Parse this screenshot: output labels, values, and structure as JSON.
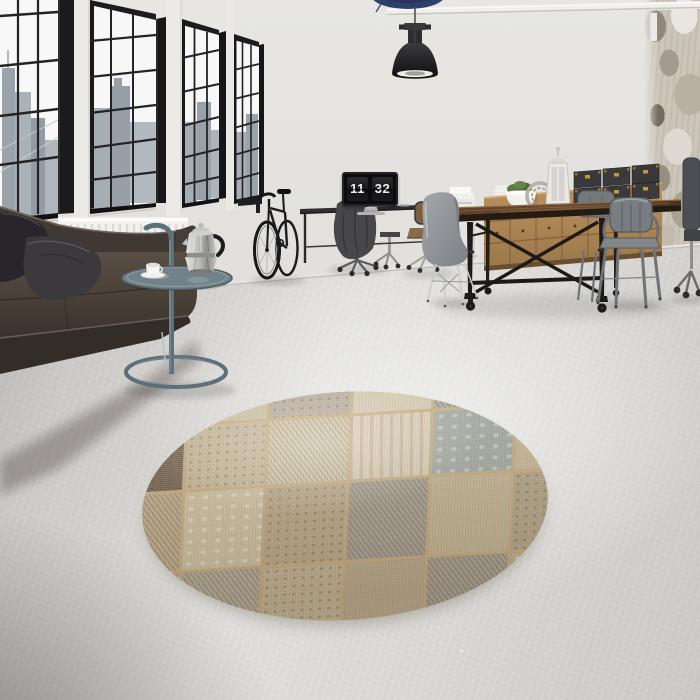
{
  "scene": {
    "type": "interior photograph",
    "setting": "industrial loft living room with round patchwork rug",
    "time_display": {
      "hours": "11",
      "minutes": "32"
    },
    "objects": [
      {
        "name": "factory-windows",
        "color": "#1c1c1e"
      },
      {
        "name": "city-skyline",
        "color": "#a7aeb4"
      },
      {
        "name": "leather-sofa",
        "color": "#463e37"
      },
      {
        "name": "throw-pillows",
        "color": "#2b292c"
      },
      {
        "name": "radiator",
        "color": "#f2f1ee"
      },
      {
        "name": "tray-side-table",
        "color": "#5d717b"
      },
      {
        "name": "moka-pot",
        "color": "#c6c6c4"
      },
      {
        "name": "espresso-cup",
        "color": "#f2f1ee"
      },
      {
        "name": "bicycle",
        "color": "#1a1a1c"
      },
      {
        "name": "pendant-lamp",
        "color": "#1d1d1f"
      },
      {
        "name": "ceiling-pipe",
        "color": "#f0efed"
      },
      {
        "name": "desk",
        "color": "#2f2f31"
      },
      {
        "name": "monitor-flip-clock",
        "color": "#0c0c0e"
      },
      {
        "name": "office-chair-with-coat",
        "color": "#47474a"
      },
      {
        "name": "wood-office-chair",
        "color": "#8a6a48"
      },
      {
        "name": "dining-table",
        "color": "#4a3320"
      },
      {
        "name": "eames-chair",
        "color": "#8f9296"
      },
      {
        "name": "tolix-armchairs",
        "color": "#787d81"
      },
      {
        "name": "wood-sideboard",
        "color": "#b08a58"
      },
      {
        "name": "storage-trunks",
        "color": "#39393b",
        "accent": "#c59a33"
      },
      {
        "name": "plant-bowl",
        "color": "#5d7a3e"
      },
      {
        "name": "lantern",
        "color": "#e9e8e4"
      },
      {
        "name": "patchwork-round-rug",
        "colors": [
          "#bfae90",
          "#6e5d49",
          "#d2c7ac",
          "#c4a391",
          "#a3a69b",
          "#d7ceb5"
        ]
      },
      {
        "name": "concrete-floor",
        "color": "#d7d6d3"
      },
      {
        "name": "distressed-wall",
        "color": "#ccc6ba"
      }
    ]
  }
}
